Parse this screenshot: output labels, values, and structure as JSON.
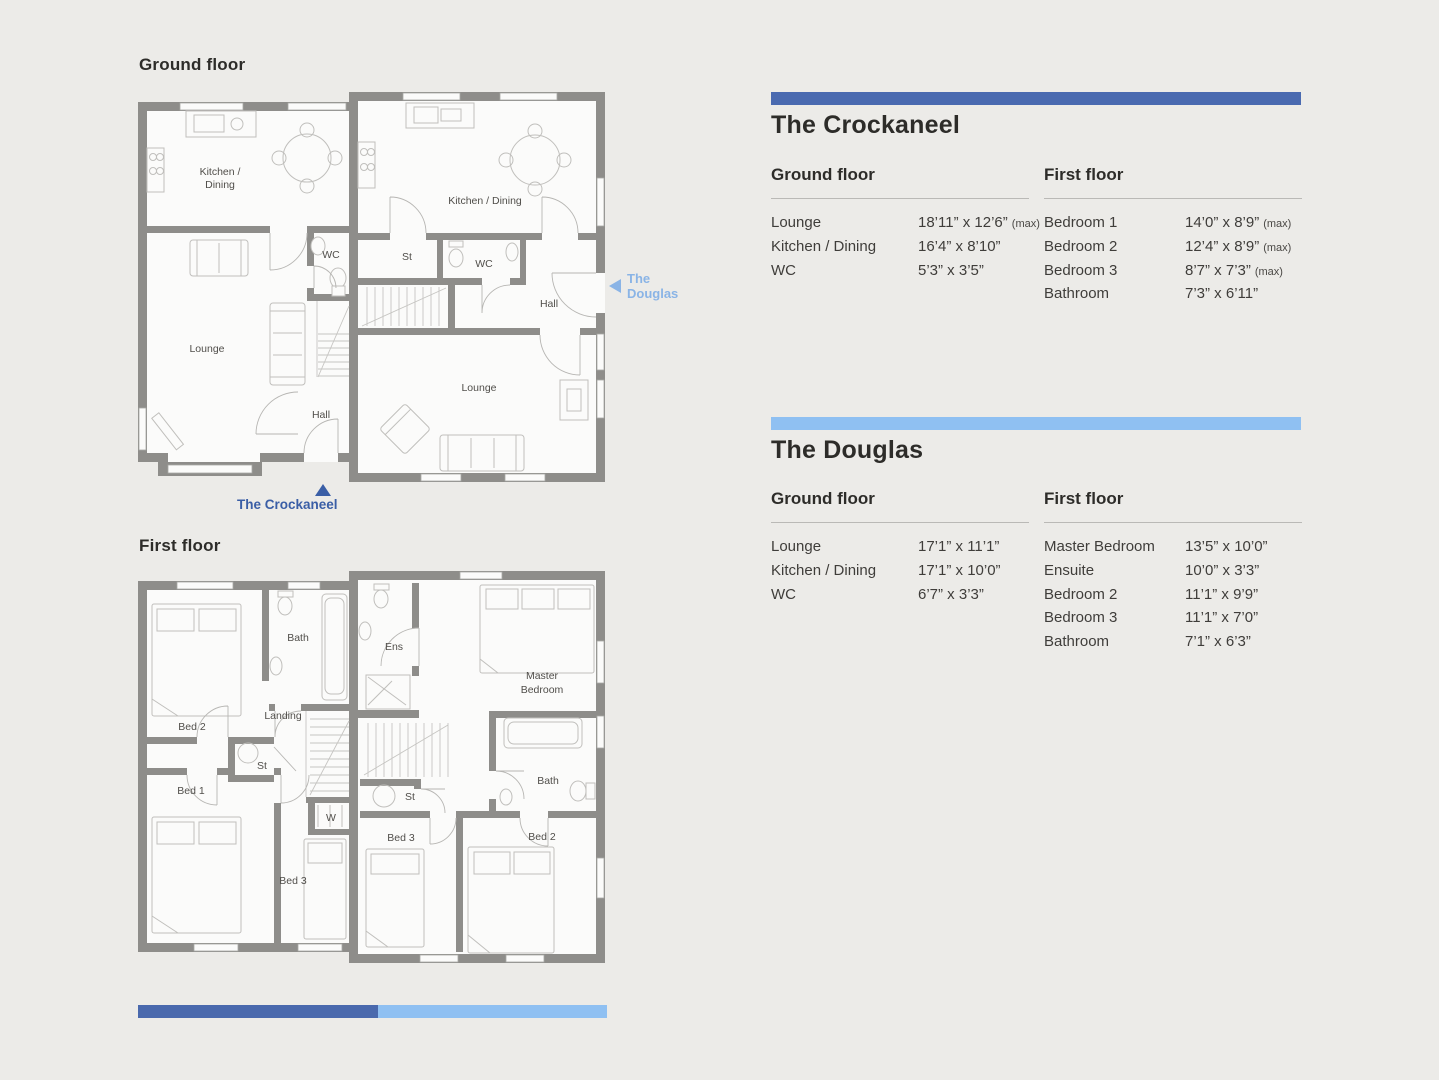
{
  "colors": {
    "background": "#ecebe8",
    "wall_gray": "#8e8d8a",
    "crockaneel_accent": "#4a6ab0",
    "douglas_accent": "#8fc0f2",
    "crockaneel_marker": "#3a5ea6",
    "douglas_marker": "#8ab4e6"
  },
  "ground_plan": {
    "heading": "Ground floor",
    "crockaneel": {
      "kitchen_line1": "Kitchen /",
      "kitchen_line2": "Dining",
      "wc": "WC",
      "lounge": "Lounge",
      "hall": "Hall"
    },
    "douglas": {
      "kitchen_dining": "Kitchen / Dining",
      "store": "St",
      "wc": "WC",
      "hall": "Hall",
      "lounge": "Lounge"
    }
  },
  "first_plan": {
    "heading": "First floor",
    "crockaneel": {
      "bed2": "Bed 2",
      "bath": "Bath",
      "landing": "Landing",
      "store": "St",
      "bed1": "Bed 1",
      "bed3": "Bed 3",
      "wardrobe": "W"
    },
    "douglas": {
      "ensuite": "Ens",
      "master_line1": "Master",
      "master_line2": "Bedroom",
      "store": "St",
      "bath": "Bath",
      "bed3": "Bed 3",
      "bed2": "Bed 2"
    }
  },
  "markers": {
    "crockaneel": "The Crockaneel",
    "douglas_line1": "The",
    "douglas_line2": "Douglas"
  },
  "tables": {
    "crockaneel": {
      "title": "The Crockaneel",
      "accent": "#4a6ab0",
      "ground": {
        "heading": "Ground floor",
        "rows": [
          {
            "room": "Lounge",
            "dims": "18’11” x 12’6”",
            "max": "(max)"
          },
          {
            "room": "Kitchen / Dining",
            "dims": "16’4” x 8’10”",
            "max": ""
          },
          {
            "room": "WC",
            "dims": "5’3” x 3’5”",
            "max": ""
          }
        ]
      },
      "first": {
        "heading": "First floor",
        "rows": [
          {
            "room": "Bedroom 1",
            "dims": "14’0” x 8’9”",
            "max": "(max)"
          },
          {
            "room": "Bedroom 2",
            "dims": "12’4” x 8’9”",
            "max": "(max)"
          },
          {
            "room": "Bedroom 3",
            "dims": "8’7” x 7’3”",
            "max": "(max)"
          },
          {
            "room": "Bathroom",
            "dims": "7’3” x 6’11”",
            "max": ""
          }
        ]
      }
    },
    "douglas": {
      "title": "The Douglas",
      "accent": "#8fc0f2",
      "ground": {
        "heading": "Ground floor",
        "rows": [
          {
            "room": "Lounge",
            "dims": "17’1” x 11’1”",
            "max": ""
          },
          {
            "room": "Kitchen / Dining",
            "dims": "17’1” x 10’0”",
            "max": ""
          },
          {
            "room": "WC",
            "dims": "6’7” x 3’3”",
            "max": ""
          }
        ]
      },
      "first": {
        "heading": "First floor",
        "rows": [
          {
            "room": "Master Bedroom",
            "dims": "13’5” x 10’0”",
            "max": ""
          },
          {
            "room": "Ensuite",
            "dims": "10’0” x 3’3”",
            "max": ""
          },
          {
            "room": "Bedroom 2",
            "dims": "11’1” x 9’9”",
            "max": ""
          },
          {
            "room": "Bedroom 3",
            "dims": "11’1” x 7’0”",
            "max": ""
          },
          {
            "room": "Bathroom",
            "dims": "7’1” x 6’3”",
            "max": ""
          }
        ]
      }
    }
  },
  "footer": {
    "dark_color": "#4a69ad",
    "light_color": "#8fc0f2"
  }
}
